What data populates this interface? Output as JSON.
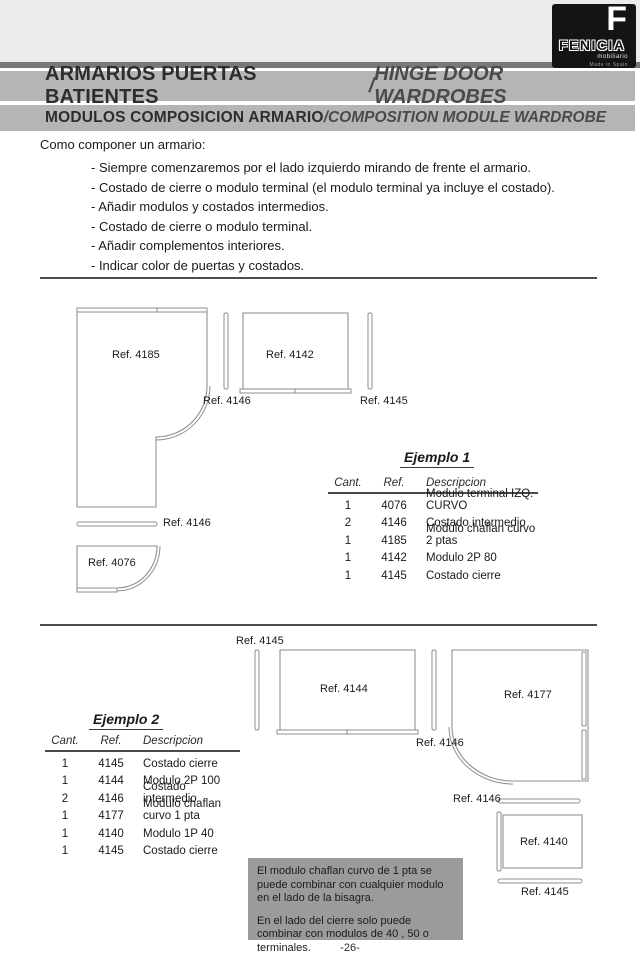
{
  "logo": {
    "f": "F",
    "brand": "FENICIA",
    "sub": "mobiliario",
    "made": "Made in Spain"
  },
  "header": {
    "banner1": {
      "es": "ARMARIOS PUERTAS BATIENTES",
      "sep": " / ",
      "en": "HINGE DOOR WARDROBES"
    },
    "banner2": {
      "es": "MODULOS COMPOSICION ARMARIO",
      "sep": " / ",
      "en": "COMPOSITION MODULE WARDROBE"
    }
  },
  "intro": {
    "title": "Como componer un armario:",
    "bullets": [
      "- Siempre comenzaremos por el lado izquierdo mirando de frente el armario.",
      "- Costado de cierre o modulo terminal (el modulo terminal ya incluye el costado).",
      "- Añadir modulos y costados intermedios.",
      "- Costado de cierre o modulo terminal.",
      "- Añadir complementos interiores.",
      "- Indicar color de puertas y costados."
    ]
  },
  "diagram1": {
    "labels": {
      "a4185": "Ref. 4185",
      "a4146": "Ref. 4146",
      "a4142": "Ref. 4142",
      "a4145": "Ref. 4145",
      "b4146": "Ref. 4146",
      "a4076": "Ref. 4076"
    }
  },
  "diagram2": {
    "labels": {
      "top4145": "Ref. 4145",
      "a4144": "Ref. 4144",
      "a4146": "Ref. 4146",
      "a4177": "Ref. 4177",
      "b4146": "Ref. 4146",
      "a4140": "Ref. 4140",
      "b4145": "Ref. 4145"
    }
  },
  "tables": {
    "ejemplo1": {
      "title": "Ejemplo 1",
      "headers": {
        "cant": "Cant.",
        "ref": "Ref.",
        "desc": "Descripcion"
      },
      "rows": [
        {
          "cant": "1",
          "ref": "4076",
          "desc": "Modulo terminal IZQ. CURVO"
        },
        {
          "cant": "2",
          "ref": "4146",
          "desc": "Costado intermedio"
        },
        {
          "cant": "1",
          "ref": "4185",
          "desc": "Modulo chaflan curvo 2 ptas"
        },
        {
          "cant": "1",
          "ref": "4142",
          "desc": "Modulo 2P 80"
        },
        {
          "cant": "1",
          "ref": "4145",
          "desc": "Costado cierre"
        }
      ]
    },
    "ejemplo2": {
      "title": "Ejemplo 2",
      "headers": {
        "cant": "Cant.",
        "ref": "Ref.",
        "desc": "Descripcion"
      },
      "rows": [
        {
          "cant": "1",
          "ref": "4145",
          "desc": "Costado cierre"
        },
        {
          "cant": "1",
          "ref": "4144",
          "desc": "Modulo 2P 100"
        },
        {
          "cant": "2",
          "ref": "4146",
          "desc": "Costado intermedio"
        },
        {
          "cant": "1",
          "ref": "4177",
          "desc": "Modulo chaflan curvo 1 pta"
        },
        {
          "cant": "1",
          "ref": "4140",
          "desc": "Modulo 1P 40"
        },
        {
          "cant": "1",
          "ref": "4145",
          "desc": "Costado cierre"
        }
      ]
    }
  },
  "note": {
    "p1": "El modulo chaflan curvo de 1 pta se puede combinar con cualquier modulo en el lado de la bisagra.",
    "p2": "En el lado del cierre solo puede combinar con modulos de 40 , 50 o terminales."
  },
  "page_number": "-26-"
}
